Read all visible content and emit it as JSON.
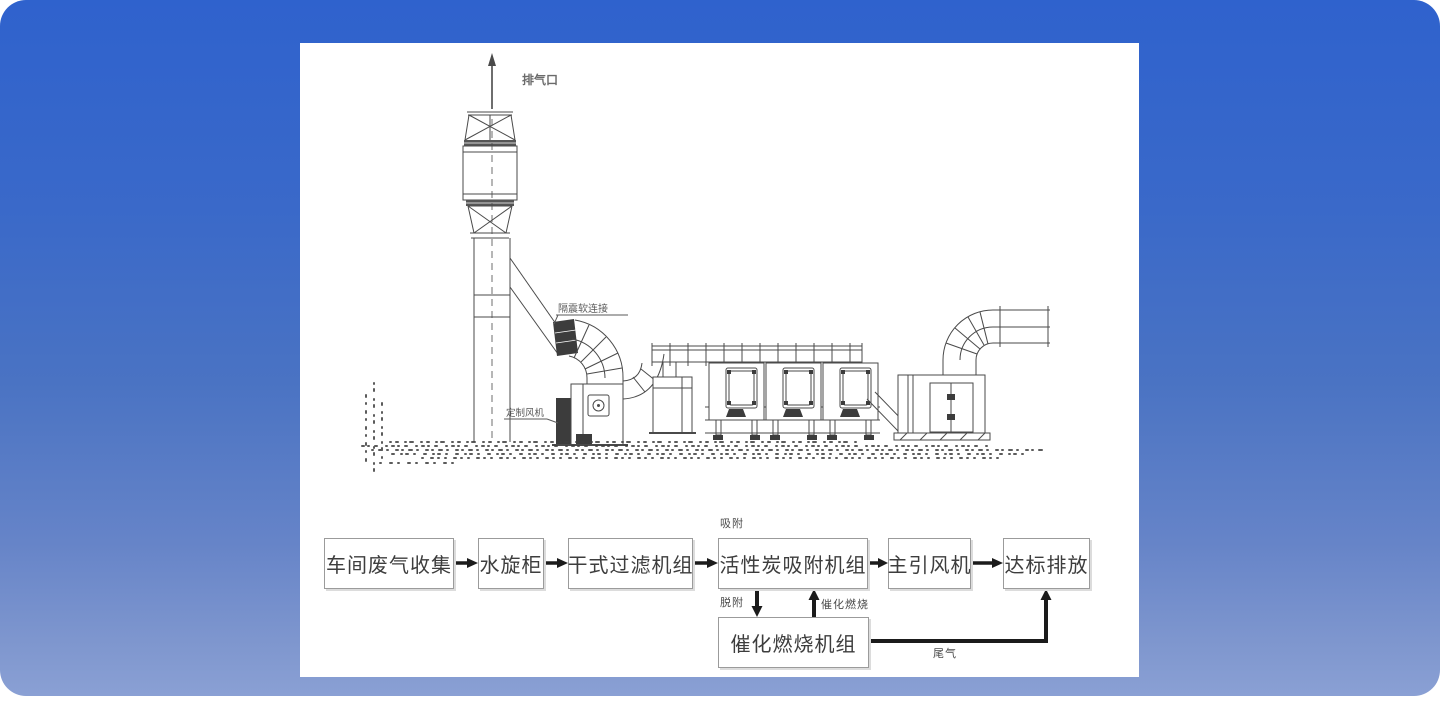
{
  "page": {
    "background_top": "#2f62cd",
    "background_bottom": "#8aa0d4",
    "panel_color": "#ffffff"
  },
  "drawing": {
    "line_color": "#4a4a4a",
    "labels": {
      "exhaust_outlet": "排气口",
      "flex_connector": "隔震软连接",
      "custom_fan": "定制风机"
    }
  },
  "flowchart": {
    "boxes": [
      {
        "id": "workshop-collection",
        "label": "车间废气收集"
      },
      {
        "id": "water-spin-cabinet",
        "label": "水旋柜"
      },
      {
        "id": "dry-filter-unit",
        "label": "干式过滤机组"
      },
      {
        "id": "carbon-adsorption-unit",
        "label": "活性炭吸附机组"
      },
      {
        "id": "main-draft-fan",
        "label": "主引风机"
      },
      {
        "id": "compliant-discharge",
        "label": "达标排放"
      },
      {
        "id": "catalytic-combustion-unit",
        "label": "催化燃烧机组"
      }
    ],
    "edge_labels": {
      "adsorb": "吸附",
      "desorb": "脱附",
      "catalytic_combustion": "催化燃烧",
      "tail_gas": "尾气"
    }
  }
}
